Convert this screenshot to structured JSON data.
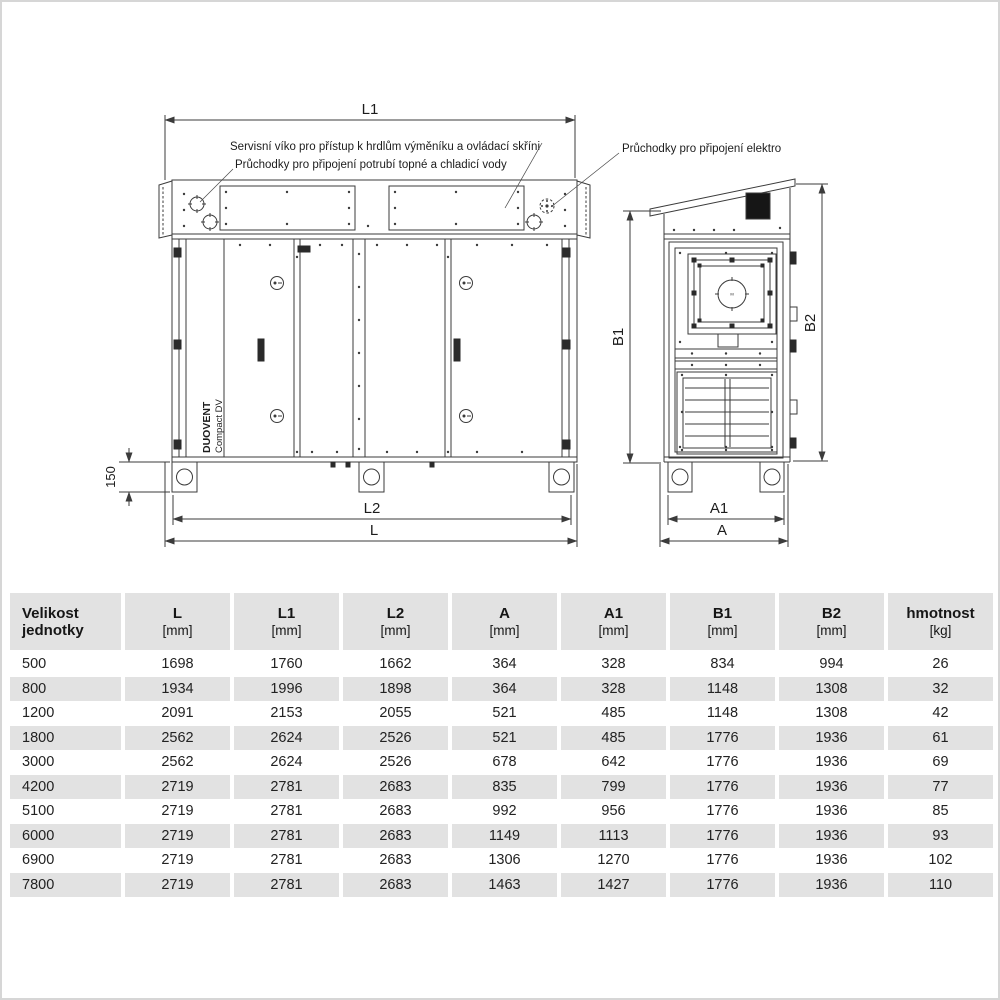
{
  "colors": {
    "table_shade": "#e2e2e2",
    "line": "#3b3b3b",
    "panel_black": "#161616"
  },
  "drawing": {
    "annotations": {
      "service_cover": "Servisní víko pro přístup k hrdlům výměníku a ovládací skříni",
      "pipe_grommets": "Průchodky pro připojení potrubí topné a chladicí vody",
      "electro_grommets": "Průchodky pro připojení elektro"
    },
    "unit_label": {
      "brand": "DUOVENT",
      "model": "Compact DV"
    },
    "fan_label": "M",
    "dimensions": {
      "l1": "L1",
      "l2": "L2",
      "l": "L",
      "a": "A",
      "a1": "A1",
      "b1": "B1",
      "b2": "B2",
      "foot_height": "150"
    }
  },
  "table": {
    "columns": [
      {
        "label": "Velikost",
        "sub": "jednotky"
      },
      {
        "label": "L",
        "sub": "[mm]"
      },
      {
        "label": "L1",
        "sub": "[mm]"
      },
      {
        "label": "L2",
        "sub": "[mm]"
      },
      {
        "label": "A",
        "sub": "[mm]"
      },
      {
        "label": "A1",
        "sub": "[mm]"
      },
      {
        "label": "B1",
        "sub": "[mm]"
      },
      {
        "label": "B2",
        "sub": "[mm]"
      },
      {
        "label": "hmotnost",
        "sub": "[kg]"
      }
    ],
    "rows": [
      [
        "500",
        "1698",
        "1760",
        "1662",
        "364",
        "328",
        "834",
        "994",
        "26"
      ],
      [
        "800",
        "1934",
        "1996",
        "1898",
        "364",
        "328",
        "1148",
        "1308",
        "32"
      ],
      [
        "1200",
        "2091",
        "2153",
        "2055",
        "521",
        "485",
        "1148",
        "1308",
        "42"
      ],
      [
        "1800",
        "2562",
        "2624",
        "2526",
        "521",
        "485",
        "1776",
        "1936",
        "61"
      ],
      [
        "3000",
        "2562",
        "2624",
        "2526",
        "678",
        "642",
        "1776",
        "1936",
        "69"
      ],
      [
        "4200",
        "2719",
        "2781",
        "2683",
        "835",
        "799",
        "1776",
        "1936",
        "77"
      ],
      [
        "5100",
        "2719",
        "2781",
        "2683",
        "992",
        "956",
        "1776",
        "1936",
        "85"
      ],
      [
        "6000",
        "2719",
        "2781",
        "2683",
        "1149",
        "1113",
        "1776",
        "1936",
        "93"
      ],
      [
        "6900",
        "2719",
        "2781",
        "2683",
        "1306",
        "1270",
        "1776",
        "1936",
        "102"
      ],
      [
        "7800",
        "2719",
        "2781",
        "2683",
        "1463",
        "1427",
        "1776",
        "1936",
        "110"
      ]
    ]
  }
}
